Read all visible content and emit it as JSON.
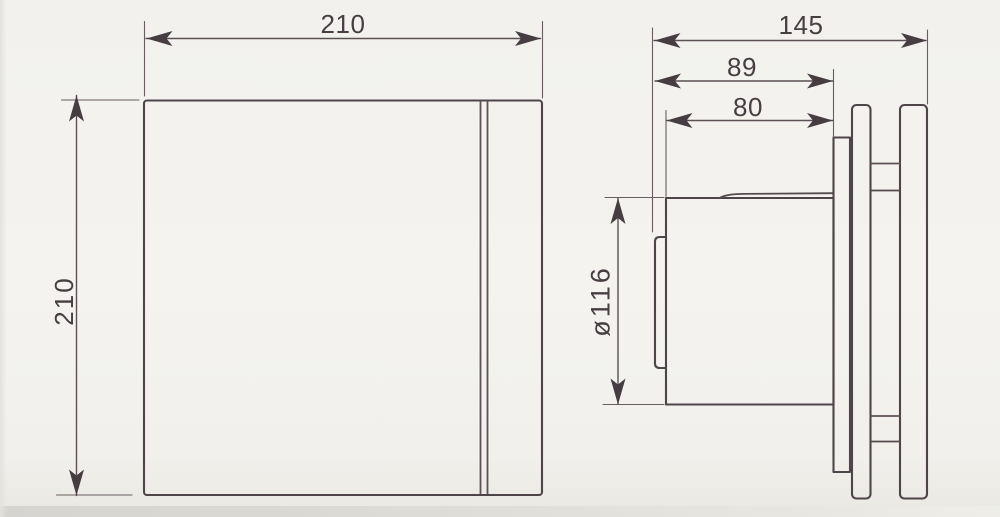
{
  "colors": {
    "background": "#f3f2ee",
    "object_line": "#4e454a",
    "dimension_line": "#5a5055",
    "text": "#473e44"
  },
  "front_view": {
    "width": "210",
    "height": "210"
  },
  "side_view": {
    "total_depth": "145",
    "body_depth": "89",
    "spigot_depth": "80",
    "spigot_diameter": "ø116"
  }
}
